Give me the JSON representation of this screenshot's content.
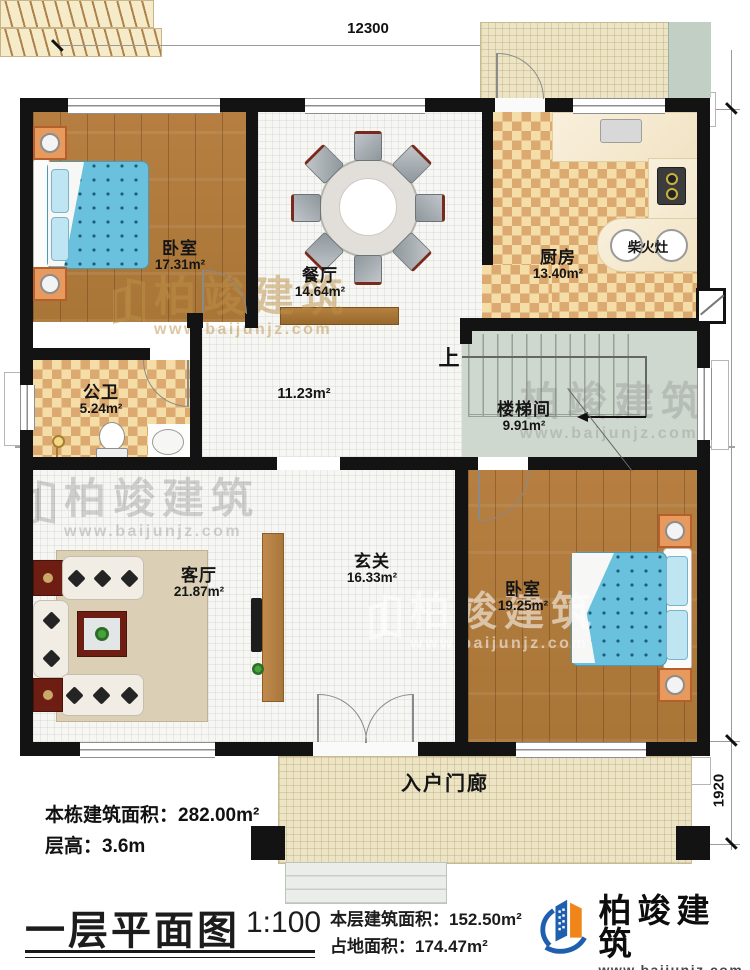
{
  "rooms": [
    {
      "name": "卧室",
      "area": "17.31m²"
    },
    {
      "name": "餐厅",
      "area": "14.64m²"
    },
    {
      "name": "厨房",
      "area": "13.40m²"
    },
    {
      "name": "公卫",
      "area": "5.24m²"
    },
    {
      "name": "",
      "area": "11.23m²"
    },
    {
      "name": "楼梯间",
      "area": "9.91m²"
    },
    {
      "name": "客厅",
      "area": "21.87m²"
    },
    {
      "name": "玄关",
      "area": "16.33m²"
    },
    {
      "name": "卧室",
      "area": "19.25m²"
    },
    {
      "name": "入户门廊",
      "area": ""
    }
  ],
  "labels": {
    "up": "上",
    "wood_stove": "柴火灶"
  },
  "dimensions": {
    "top_width": "12300",
    "right_height": "11600",
    "porch_depth": "1920"
  },
  "annotations": {
    "building_area": "本栋建筑面积：282.00m²",
    "floor_height": "层高：3.6m"
  },
  "titleblock": {
    "title": "一层平面图",
    "scale": "1:100",
    "floor_area": "本层建筑面积：152.50m²",
    "footprint": "占地面积：174.47m²"
  },
  "logo": {
    "name": "柏竣建筑",
    "url": "www.baijunjz.com"
  },
  "watermark": {
    "text": "柏竣建筑",
    "url": "www.baijunjz.com"
  },
  "colors": {
    "wall": "#131313",
    "wood": "#b1793a",
    "checker": "#dcaa70",
    "stair": "#cfd8ce",
    "porch": "#ece4c5",
    "logo_blue": "#1e5fae",
    "logo_orange": "#f08519"
  }
}
